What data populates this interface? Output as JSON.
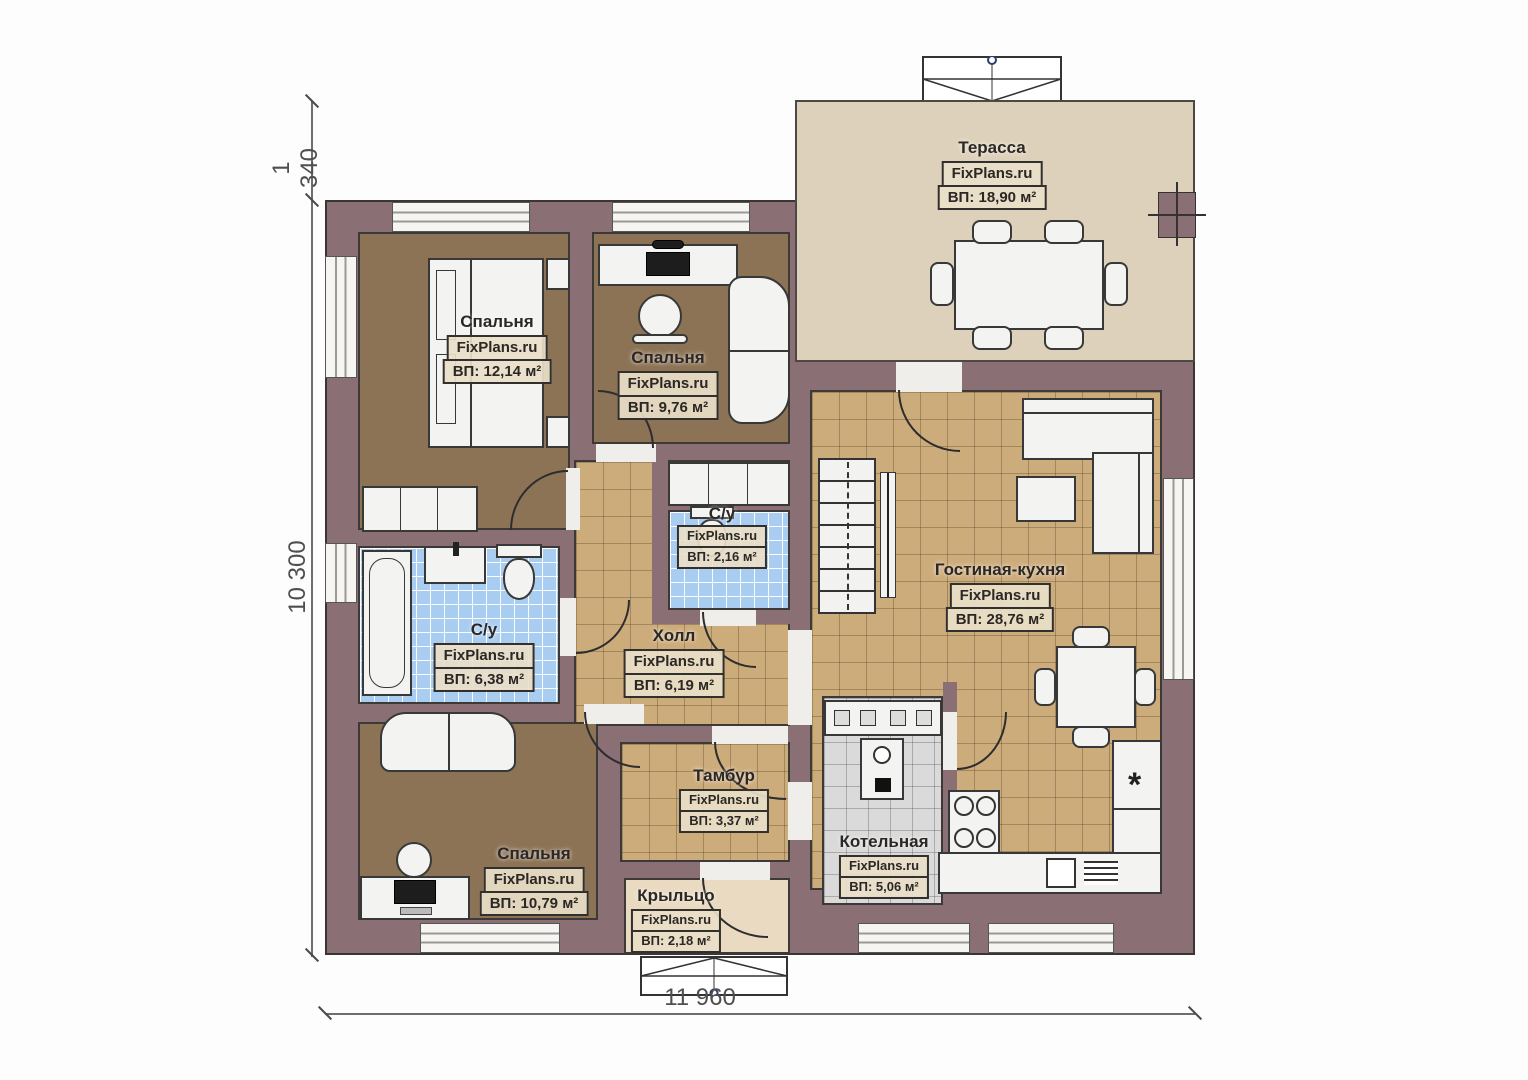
{
  "plan": {
    "watermark": "FixPlans.ru",
    "rooms": [
      {
        "id": "terrace",
        "name": "Терасса",
        "area": "ВП: 18,90 м²"
      },
      {
        "id": "bedroom1",
        "name": "Спальня",
        "area": "ВП: 12,14 м²"
      },
      {
        "id": "bedroom2",
        "name": "Спальня",
        "area": "ВП: 9,76 м²"
      },
      {
        "id": "bath1",
        "name": "С/у",
        "area": "ВП: 6,38 м²"
      },
      {
        "id": "bath2",
        "name": "С/у",
        "area": "ВП: 2,16 м²"
      },
      {
        "id": "hall",
        "name": "Холл",
        "area": "ВП: 6,19 м²"
      },
      {
        "id": "living",
        "name": "Гостиная-кухня",
        "area": "ВП: 28,76 м²"
      },
      {
        "id": "tambour",
        "name": "Тамбур",
        "area": "ВП: 3,37 м²"
      },
      {
        "id": "boiler",
        "name": "Котельная",
        "area": "ВП: 5,06 м²"
      },
      {
        "id": "bedroom3",
        "name": "Спальня",
        "area": "ВП: 10,79 м²"
      },
      {
        "id": "porch",
        "name": "Крыльцо",
        "area": "ВП: 2,18 м²"
      }
    ],
    "dimensions": {
      "vertical_upper": "1 340",
      "vertical_main": "10 300",
      "horizontal_bottom": "11 960"
    },
    "colors": {
      "wall": "#8a6f74",
      "bedroom_floor": "#8c7356",
      "tile_floor": "#cdac7c",
      "bath_tile": "#a9cdf1",
      "boiler_tile": "#dadada",
      "terrace_floor": "#ded1bb",
      "porch_floor": "#e9dac1"
    }
  }
}
